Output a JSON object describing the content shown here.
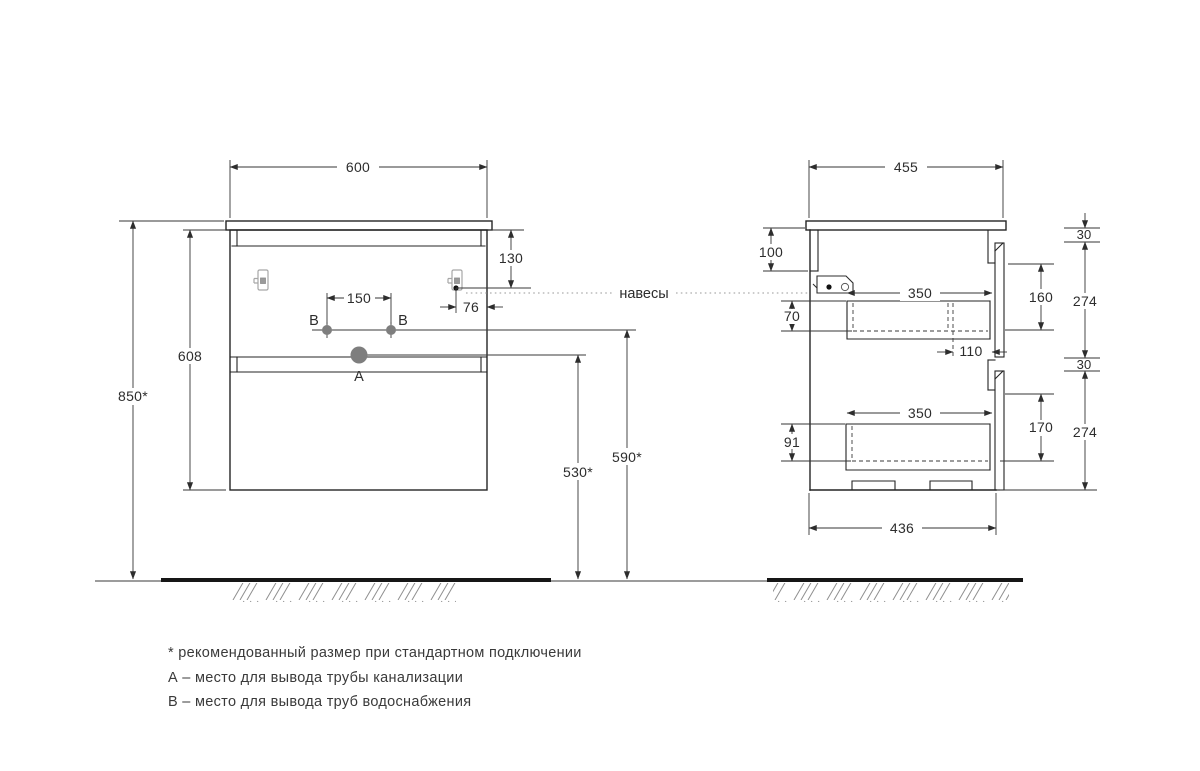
{
  "labels": {
    "hangers": "навесы",
    "hole_a": "А",
    "hole_b_left": "В",
    "hole_b_right": "В"
  },
  "front": {
    "width": "600",
    "cabinet_height": "608",
    "install_height": "850*",
    "bracket_top_offset": "130",
    "supply_spacing": "150",
    "bracket_edge_offset": "76",
    "drain_floor_height": "530*",
    "supply_floor_height": "590*"
  },
  "side": {
    "depth": "455",
    "back_rail_height": "100",
    "hanger_drawer_gap": "70",
    "top_drawer_depth": "350",
    "siphon_cutout_depth": "110",
    "top_drawer_inner_height": "160",
    "top_front_height": "274",
    "top_gap": "30",
    "bottom_gap": "30",
    "bottom_drawer_top_offset": "91",
    "bottom_drawer_depth": "350",
    "bottom_drawer_inner_height": "170",
    "bottom_front_height": "274",
    "base_depth": "436"
  },
  "footnotes": {
    "asterisk": "* рекомендованный размер при стандартном подключении",
    "a": "А – место для вывода трубы канализации",
    "b": "В – место для вывода труб водоснабжения"
  }
}
